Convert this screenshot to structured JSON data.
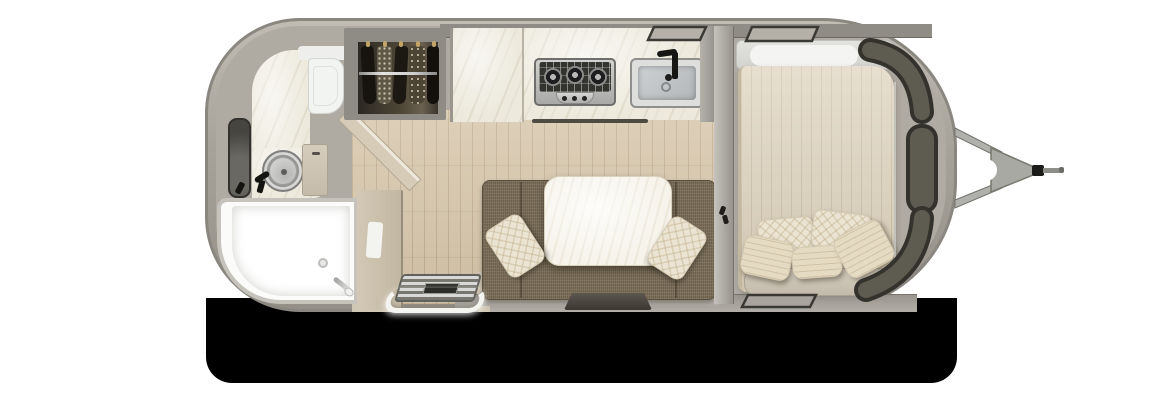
{
  "scene": {
    "type": "travel-trailer-floorplan-top-view",
    "orientation": "rear at left, hitch at right",
    "background_color": "#ffffff",
    "shadow_color": "#000000"
  },
  "palette": {
    "shell": "#a6a29a",
    "shell_edge": "#8a8781",
    "interior_wall": "#8f8c86",
    "floor_wood": "#d7c7ab",
    "marble_counter": "#edeadd",
    "table_marble": "#f6f3ea",
    "sofa_fabric": "#7b6e59",
    "bed_quilt": "#ddd2bc",
    "pillow_knit": "#ece4d2",
    "pillow_bolster": "#e5dbc3",
    "window_glass": "#5e5b50",
    "window_frame": "#34322c",
    "stainless": "#c9c9c7",
    "fixture_black": "#161614",
    "shower_white": "#fbfbfa",
    "door_beige": "#cabfab",
    "hitch_metal": "#a9a9a4"
  },
  "rooms": {
    "bathroom": {
      "label": "Rear wet bathroom",
      "items": [
        "shower pan",
        "round vanity sink",
        "black faucet",
        "mirror",
        "toilet",
        "vanity cabinet",
        "bathroom door"
      ]
    },
    "wardrobe": {
      "label": "Wardrobe closet with hanging rod",
      "items": [
        "hanging rod",
        "five garments",
        "gold hangers"
      ]
    },
    "kitchen": {
      "label": "Galley kitchen",
      "items": [
        "pantry cabinet",
        "marble countertop",
        "three-burner cooktop",
        "stainless sink",
        "black faucet"
      ]
    },
    "lounge": {
      "label": "Dinette lounge",
      "items": [
        "u-shaped sofa",
        "marble dinette table",
        "two knit throw pillows",
        "dark floor mat"
      ]
    },
    "entry": {
      "label": "Entry step",
      "items": [
        "metal step grate",
        "white grab rail"
      ]
    },
    "bedroom": {
      "label": "Front bedroom",
      "items": [
        "quilted bed",
        "headboard shelf",
        "two knit pillows",
        "three striped bolster pillows",
        "foot bench"
      ]
    },
    "exterior": {
      "label": "Front windows and hitch",
      "items": [
        "two roof windows",
        "curved corner windows",
        "side window",
        "rear roof window",
        "a-frame tongue",
        "coupler"
      ]
    }
  },
  "counts": {
    "cooktop_burners": 3,
    "cooktop_knobs": 3,
    "bed_pillows": 5,
    "sofa_pillows": 2,
    "wardrobe_garments": 5,
    "front_window_panels": 3,
    "top_roof_windows": 2,
    "bottom_roof_windows": 1
  }
}
